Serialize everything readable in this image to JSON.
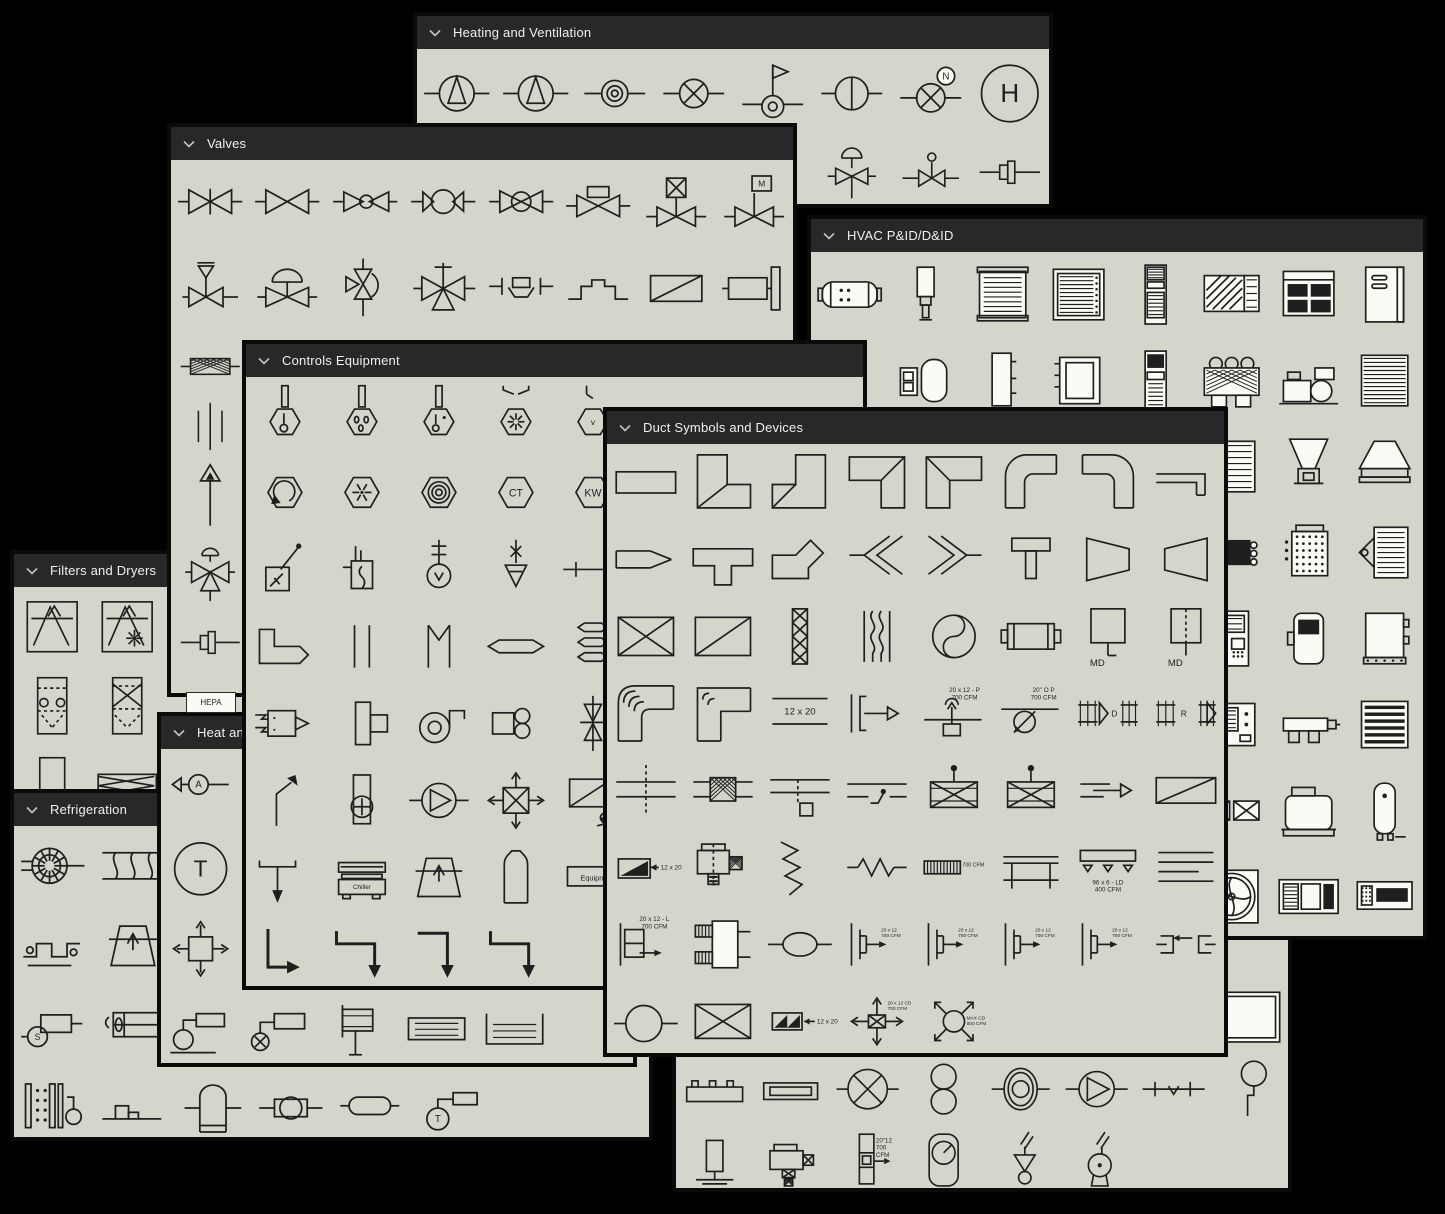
{
  "colors": {
    "page_bg": "#000000",
    "panel_bg": "#d6d5cc",
    "header_bg": "#282828",
    "header_text": "#f0f0f0",
    "stroke": "#1f1f1f",
    "symbol_fill_white": "#fbfbf6",
    "border": "#0a0a0a"
  },
  "icons": {
    "header_chevron": "chevron-down-icon"
  },
  "loose": [
    {
      "label": "HEPA",
      "x": 186,
      "y": 692,
      "w": 48,
      "h": 19
    }
  ],
  "panels": [
    {
      "id": "heating-ventilation",
      "title": "Heating and Ventilation",
      "header": true,
      "x": 413,
      "y": 12,
      "w": 640,
      "h": 196,
      "z": 1,
      "cols": 8,
      "rows": [
        {
          "h": 88,
          "cells": [
            "pump-tri",
            "pump-tri",
            "ring-circle",
            "circle-x",
            "flag-valve",
            "circle-vline",
            [
              "circle-x-n",
              "N"
            ],
            [
              "h-circle",
              "H"
            ]
          ]
        },
        {
          "h": 70,
          "cells": [
            0,
            0,
            0,
            0,
            0,
            "relief-dome",
            "stem-ball",
            "coupling"
          ]
        }
      ]
    },
    {
      "id": "filters-dryers",
      "title": "Filters and Dryers",
      "header": true,
      "x": 10,
      "y": 550,
      "w": 310,
      "h": 295,
      "z": 2,
      "cols": 4,
      "rows": [
        {
          "h": 80,
          "cells": [
            "filter-box",
            "filter-box-star",
            0,
            0
          ]
        },
        {
          "h": 80,
          "cells": [
            "dryer-dash",
            "dryer-x",
            0,
            0
          ]
        },
        {
          "h": 80,
          "cells": [
            "rect-plain",
            "zigzag-rect",
            0,
            0
          ]
        }
      ]
    },
    {
      "id": "valves",
      "title": "Valves",
      "header": true,
      "x": 167,
      "y": 123,
      "w": 630,
      "h": 574,
      "z": 3,
      "cols": 8,
      "rows": [
        {
          "h": 84,
          "cells": [
            "gate",
            "globe",
            "bowtie-circ",
            "ball",
            "circle-bowtie",
            "box-bowtie",
            "xbox-stem",
            [
              "m-flag",
              "M"
            ]
          ]
        },
        {
          "h": 88,
          "cells": [
            "relief-bar",
            "diaphragm",
            "angle-half",
            "three-way",
            "flanged-boat",
            "raised-step",
            "diag-rect",
            "actuator-cyl"
          ]
        },
        {
          "h": 60,
          "cells": [
            "strainer",
            0,
            0,
            0,
            0,
            0,
            0,
            0
          ]
        },
        {
          "h": 64,
          "cells": [
            "three-vlines",
            0,
            0,
            0,
            0,
            0,
            0,
            0
          ]
        },
        {
          "h": 80,
          "cells": [
            "arrow-up",
            0,
            0,
            0,
            0,
            0,
            0,
            0
          ]
        },
        {
          "h": 72,
          "cells": [
            "four-way",
            0,
            0,
            0,
            0,
            0,
            0,
            0
          ]
        },
        {
          "h": 56,
          "cells": [
            "coupling",
            0,
            0,
            0,
            0,
            0,
            0,
            0
          ]
        }
      ]
    },
    {
      "id": "refrigeration",
      "title": "Refrigeration",
      "header": true,
      "x": 10,
      "y": 789,
      "w": 643,
      "h": 352,
      "z": 4,
      "cols": 8,
      "rows": [
        {
          "h": 80,
          "cells": [
            "comp-gear",
            "coil-wavy",
            0,
            0,
            0,
            0,
            0,
            0
          ]
        },
        {
          "h": 80,
          "cells": [
            "tube-coil",
            "tower-trap2",
            0,
            0,
            0,
            0,
            0,
            0
          ]
        },
        {
          "h": 80,
          "cells": [
            [
              "s-compressor",
              "S"
            ],
            "fan-rect",
            0,
            0,
            0,
            0,
            0,
            0
          ]
        },
        {
          "h": 80,
          "cells": [
            "evap-plates",
            "step-box",
            "dome-tank-sm",
            "ball-inline",
            "capsule-sm",
            [
              "t-circle-rect",
              "T"
            ],
            0,
            0
          ]
        }
      ]
    },
    {
      "id": "heat",
      "title": "Heat and",
      "header": true,
      "x": 157,
      "y": 712,
      "w": 480,
      "h": 355,
      "z": 5,
      "cols": 6,
      "rows": [
        {
          "h": 80,
          "cells": [
            [
              "a-circle-arrow",
              "A"
            ],
            0,
            0,
            0,
            0,
            0
          ]
        },
        {
          "h": 80,
          "cells": [
            [
              "t-circle-big",
              "T"
            ],
            0,
            0,
            0,
            0,
            0
          ]
        },
        {
          "h": 80,
          "cells": [
            "cross-box-arrows",
            0,
            0,
            0,
            0,
            0
          ]
        },
        {
          "h": 80,
          "cells": [
            "sensor-circle-rect",
            "circlex-rect",
            "radiator-lines",
            "convector-a",
            "convector-b",
            0
          ]
        }
      ]
    },
    {
      "id": "hidden-panel",
      "title": "",
      "header": false,
      "x": 672,
      "y": 905,
      "w": 620,
      "h": 287,
      "z": 6,
      "cols": 8,
      "rows": [
        {
          "h": 72,
          "cells": [
            0,
            0,
            0,
            0,
            0,
            0,
            0,
            0
          ]
        },
        {
          "h": 72,
          "cells": [
            0,
            0,
            0,
            0,
            0,
            0,
            0,
            "white-rect"
          ]
        },
        {
          "h": 72,
          "cells": [
            "baseboard",
            "fin-tube",
            "fan-x-circle",
            "dbl-circles",
            "ring-fan",
            "pump-circle2",
            "check-line",
            "pendant"
          ]
        },
        {
          "h": 72,
          "cells": [
            "vert-heater",
            "motor-heater",
            [
              "duct-heater-cfm",
              "20\"12\n700\nCFM"
            ],
            "gauge-rrect",
            "filter-funnel",
            "bulb-unit",
            0,
            0
          ]
        }
      ]
    },
    {
      "id": "hvac-pid",
      "title": "HVAC P&ID/D&ID",
      "header": true,
      "x": 807,
      "y": 215,
      "w": 620,
      "h": 725,
      "z": 7,
      "cols": 8,
      "rows": [
        {
          "h": 86,
          "cells": [
            "tank-h",
            "cyl-v",
            "grille-box",
            "grille-box2",
            "tall-cabinet",
            "window-unit",
            "packaged-unit",
            "cabinet-door"
          ]
        },
        {
          "h": 86,
          "cells": [
            "panel-sm",
            "pod-pair",
            "panel-flat",
            "coil-box",
            "console-tall",
            "condenser-fans",
            "chiller-skid",
            "coil-stack"
          ]
        },
        {
          "h": 86,
          "cells": [
            0,
            0,
            0,
            0,
            0,
            "louver-part",
            "hopper-funnel",
            "hood"
          ]
        },
        {
          "h": 86,
          "cells": [
            0,
            0,
            0,
            0,
            0,
            "black-coil",
            "dot-coil",
            "fin-bracket"
          ]
        },
        {
          "h": 86,
          "cells": [
            0,
            0,
            0,
            0,
            0,
            "control-cab",
            "console-sm",
            "wall-box"
          ]
        },
        {
          "h": 86,
          "cells": [
            0,
            0,
            0,
            0,
            0,
            "screen-panel",
            "manifold",
            "louver-stack"
          ]
        },
        {
          "h": 86,
          "cells": [
            0,
            0,
            0,
            0,
            0,
            "xx-box",
            "ahu-base",
            "water-heater"
          ]
        },
        {
          "h": 86,
          "cells": [
            0,
            0,
            0,
            0,
            0,
            "fan-wheel",
            "rooftop-unit",
            "cassette"
          ]
        }
      ]
    },
    {
      "id": "controls",
      "title": "Controls Equipment",
      "header": true,
      "x": 242,
      "y": 340,
      "w": 625,
      "h": 650,
      "z": 8,
      "cols": 8,
      "rows": [
        {
          "h": 77,
          "cells": [
            "thermo-hex",
            "thermo-hex-drops",
            "thermo-hex-dot",
            "hex-funnel",
            [
              "hex-v",
              "v"
            ],
            0,
            0,
            0
          ]
        },
        {
          "h": 77,
          "cells": [
            "hex-rotate",
            "hex-star",
            "hex-rings",
            [
              "hex-txt",
              "CT"
            ],
            [
              "hex-txt",
              "KW"
            ],
            0,
            0,
            0
          ]
        },
        {
          "h": 77,
          "cells": [
            "relay-box",
            "box-squiggle",
            "stem-circle-cross",
            "drop-triangle",
            "line-cross",
            0,
            0,
            0
          ]
        },
        {
          "h": 77,
          "cells": [
            "elbow-duct-arrow",
            "two-vlines",
            "m-lines",
            "capsule-flat",
            "hex-stack",
            0,
            0,
            0
          ]
        },
        {
          "h": 77,
          "cells": [
            "pneumatic-box",
            "tee-box",
            "blower-spiral",
            "box-fan",
            "butterfly-x",
            0,
            0,
            0
          ]
        },
        {
          "h": 77,
          "cells": [
            "bent-arrow",
            "tank-circle-plus",
            "pump-circle-tri",
            "box-x-arrows",
            "diagbox-arrow",
            0,
            0,
            0
          ]
        },
        {
          "h": 77,
          "cells": [
            "tee-down-arrow",
            [
              "chiller-box",
              "Chiller"
            ],
            "tower-trap2",
            "dome-tank",
            [
              "equip-rect",
              "Equipm"
            ],
            0,
            0,
            0
          ]
        },
        {
          "h": 77,
          "cells": [
            "l-pipe-1",
            "l-pipe-2",
            "l-pipe-3",
            "l-pipe-2",
            0,
            0,
            0,
            0
          ]
        }
      ]
    },
    {
      "id": "duct",
      "title": "Duct Symbols and Devices",
      "header": true,
      "x": 603,
      "y": 407,
      "w": 625,
      "h": 650,
      "z": 9,
      "cols": 8,
      "rows": [
        {
          "h": 77,
          "cells": [
            "duct-rect",
            "elbow1",
            "elbow2",
            "elbow3",
            "elbow4",
            "relbow",
            "relbow2",
            "elbow-thin"
          ]
        },
        {
          "h": 77,
          "cells": [
            "trans-thin",
            "tee-duct",
            "boot",
            "wye-l",
            "wye-r",
            "takeoff-t",
            "trap-r",
            "trap-l"
          ]
        },
        {
          "h": 77,
          "cells": [
            "x-box",
            "diag-box",
            "hatch-strip",
            "bellows",
            "yinyang",
            "attenuator",
            [
              "md-box",
              "MD"
            ],
            [
              "md-box2",
              "MD"
            ]
          ]
        },
        {
          "h": 77,
          "cells": [
            "vane-elbow",
            "vane-elbow-sq",
            [
              "lines-label",
              "12 x 20"
            ],
            "endcap-arrow",
            [
              "riser-p",
              "20 x 12 - P\n700 CFM"
            ],
            [
              "drop-round",
              "20\" O P\n700 CFM"
            ],
            [
              "damper-d",
              "D"
            ],
            [
              "damper-r",
              "R"
            ]
          ]
        },
        {
          "h": 77,
          "cells": [
            "cross-dash",
            "mesh-joint",
            "dash-drop-box",
            "stat-line",
            "boxx-dot",
            "boxx-dot",
            "arrow-line",
            "diag-rect-wide"
          ]
        },
        {
          "h": 77,
          "cells": [
            [
              "wedge-label",
              "12 x 20"
            ],
            "smoke-unit",
            "zigzag-flex",
            "resist-zig",
            [
              "hatch-label",
              "700 CFM"
            ],
            "bench",
            [
              "drop-grid",
              "96 x 6 - LD\n400 CFM"
            ],
            "four-hlines"
          ]
        },
        {
          "h": 77,
          "cells": [
            [
              "box-l",
              "20 x 12 - L\n700 CFM"
            ],
            "dbl-inlet",
            "ellipse-inline",
            [
              "takeoff-lbl",
              "20 x 12\n700 CFM"
            ],
            [
              "takeoff-lbl",
              "20 x 12\n700 CFM"
            ],
            [
              "takeoff-lbl",
              "20 x 12\n700 CFM"
            ],
            [
              "takeoff-lbl",
              "20 x 12\n700 CFM"
            ],
            "splice-sym"
          ]
        },
        {
          "h": 77,
          "cells": [
            "circle-inline",
            "xbox-lg",
            [
              "xwedge",
              "12 x 20"
            ],
            [
              "diffuser-4way",
              "20 x 12 CD\n700 CFM"
            ],
            [
              "diffuser-round",
              "MAX CD\n800 CFM"
            ],
            0,
            0,
            0
          ]
        }
      ]
    }
  ]
}
